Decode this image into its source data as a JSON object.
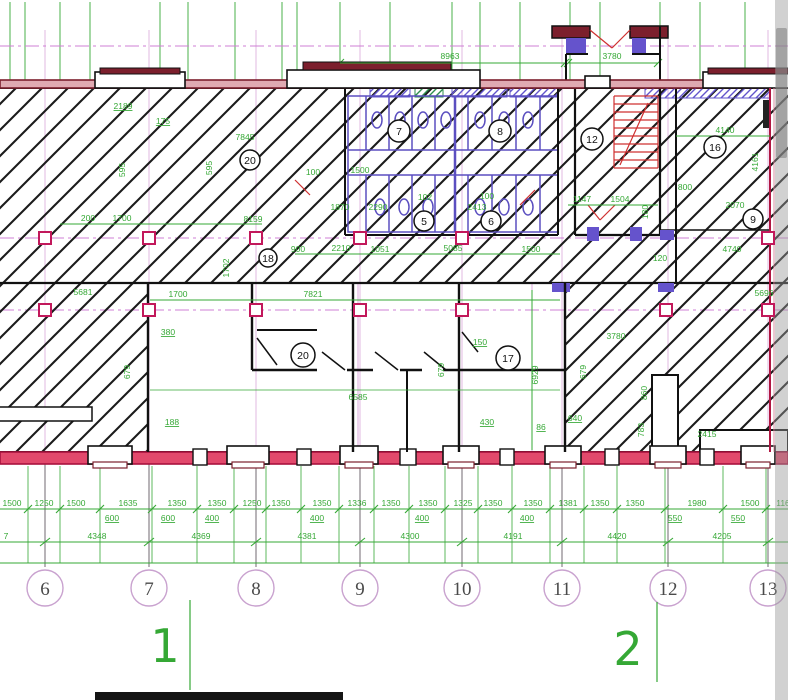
{
  "drawing": {
    "top_dims": {
      "span_left": "8963",
      "span_right": "3780"
    },
    "upper_left": {
      "w2189": "2189",
      "w175": "175",
      "w7845": "7845",
      "v595a": "595",
      "v595b": "595",
      "w200": "200",
      "w1700": "1700",
      "w8159": "8159",
      "v1702": "1702",
      "w5681": "5681"
    },
    "sanitary": {
      "w100a": "100",
      "w1500a": "1500",
      "w1870": "1870",
      "w2290": "2290",
      "w102": "102",
      "w100b": "100",
      "w2413": "2413",
      "w900": "900",
      "w2210": "2210",
      "w1051": "1051",
      "w5085": "5085",
      "w1500b": "1500"
    },
    "upper_right": {
      "w4140": "4140",
      "v4161": "4161",
      "w800": "800",
      "w2070": "2070",
      "w1147": "1147",
      "w1504": "1504",
      "w120": "120",
      "w4740": "4740",
      "v180": "180"
    },
    "lower_mid": {
      "w1700": "1700",
      "w7821": "7821",
      "w380": "380",
      "v679a": "679",
      "w188": "188",
      "w150": "150",
      "v679b": "679",
      "v6929": "6929",
      "w6585": "6585",
      "w430": "430",
      "w86": "86"
    },
    "lower_right": {
      "w3780": "3780",
      "v679": "679",
      "v860": "860",
      "v783": "783",
      "w2415": "2415",
      "w5696": "5696",
      "w640": "640"
    },
    "room_circles_upper": [
      "20",
      "18",
      "7",
      "8",
      "5",
      "6",
      "12",
      "16",
      "9"
    ],
    "room_circles_lower": [
      "20",
      "17"
    ]
  },
  "bottom": {
    "chain1": [
      "1500",
      "1250",
      "1500",
      "1635",
      "1350",
      "1350",
      "1250",
      "1350",
      "1350",
      "1336",
      "1350",
      "1350",
      "1325",
      "1350",
      "1350",
      "1381",
      "1350",
      "1350",
      "1980",
      "1500",
      "116"
    ],
    "chain1_leaders": [
      "600",
      "600",
      "400",
      "400",
      "400",
      "400",
      "550",
      "550"
    ],
    "chain2": [
      "7",
      "4348",
      "4369",
      "4381",
      "4300",
      "4191",
      "4420",
      "4205"
    ],
    "grid_bubbles": [
      "6",
      "7",
      "8",
      "9",
      "10",
      "11",
      "12",
      "13"
    ],
    "zone_labels": [
      "1",
      "2"
    ]
  },
  "colors": {
    "dim_green": "#35a835",
    "crimson": "#c01848",
    "maroon": "#7c1f2d",
    "purple": "#6254cc",
    "magenta_axis": "#cf7fd4",
    "hatch_black": "#1b1b1b",
    "bubble_stroke": "#c9a2cf"
  }
}
